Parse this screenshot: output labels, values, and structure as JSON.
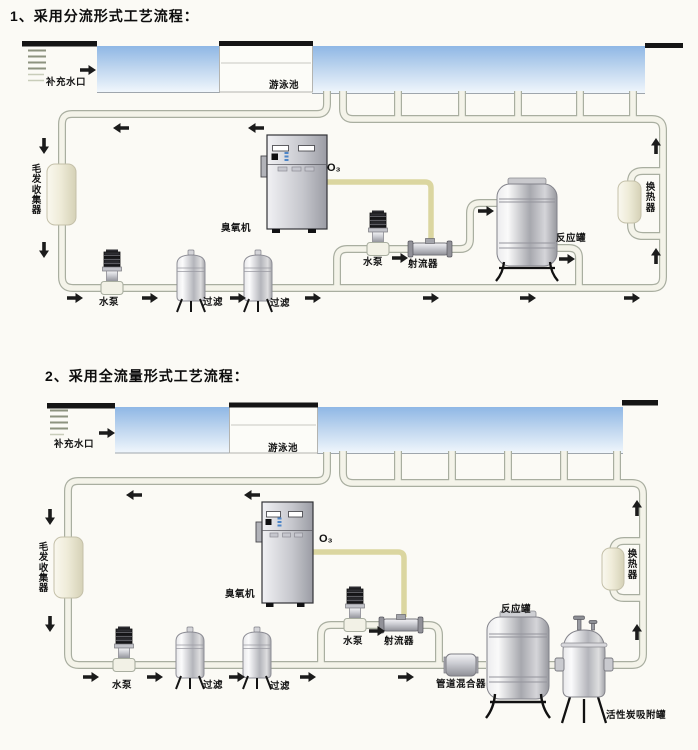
{
  "colors": {
    "background": "#fbfaf5",
    "water_top": "#8fb7e5",
    "water_bottom": "#f0f6fc",
    "pipe_fill": "#f4f3e9",
    "pipe_edge": "#a9aea0",
    "ozone_line": "#dbd6a0",
    "pool_deck_black": "#151515",
    "arrow": "#1b1b1b"
  },
  "flow1": {
    "title": "1、采用分流形式工艺流程：",
    "labels": {
      "makeup_inlet": "补充水口",
      "pool": "游泳池",
      "hair_collector": "毛发收集器",
      "main_pump": "水泵",
      "filter_a": "过滤",
      "filter_b": "过滤",
      "ozone_generator": "臭氧机",
      "ozone_gas": "O₃",
      "booster_pump": "水泵",
      "jet_injector": "射流器",
      "reaction_tank": "反应罐",
      "heat_exchanger": "换热器"
    }
  },
  "flow2": {
    "title": "2、采用全流量形式工艺流程：",
    "labels": {
      "makeup_inlet": "补充水口",
      "pool": "游泳池",
      "hair_collector": "毛发收集器",
      "main_pump": "水泵",
      "filter_a": "过滤",
      "filter_b": "过滤",
      "ozone_generator": "臭氧机",
      "ozone_gas": "O₃",
      "booster_pump": "水泵",
      "jet_injector": "射流器",
      "pipeline_mixer": "管道混合器",
      "reaction_tank": "反应罐",
      "activated_carbon_tank": "活性炭吸附罐",
      "heat_exchanger": "换热器"
    }
  }
}
